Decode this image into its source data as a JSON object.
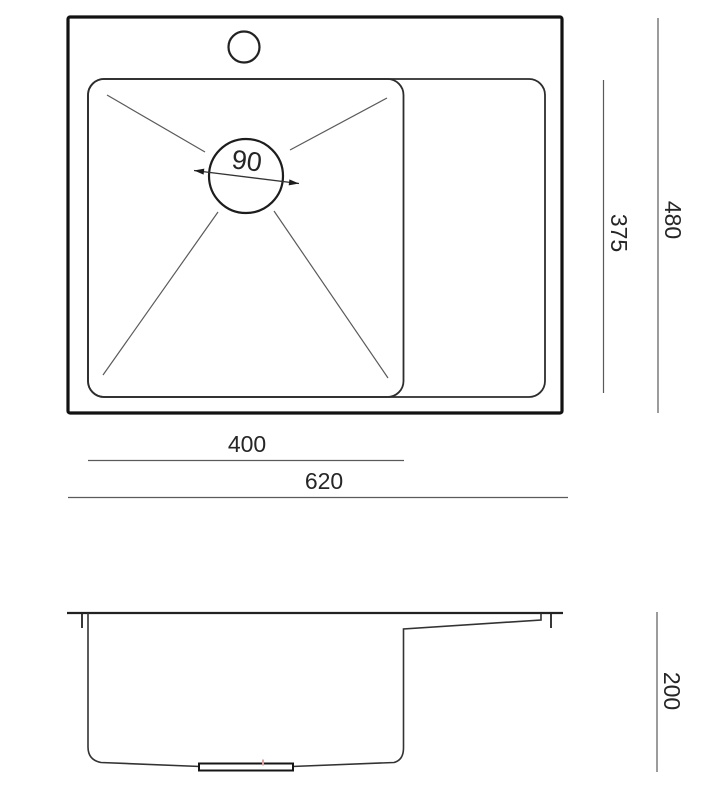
{
  "drawing": {
    "kind": "kitchen-sink-technical-drawing",
    "colors": {
      "background": "#ffffff",
      "thick_outline": "#121212",
      "medium_line": "#2d2d2d",
      "thin_line": "#5a5a5a",
      "label_text": "#262626",
      "drain_center_accent": "#e2a1a1"
    },
    "top_view": {
      "labels": {
        "drain_diameter": "90",
        "bowl_depth": "375",
        "overall_depth": "480",
        "bowl_width": "400",
        "overall_width": "620"
      }
    },
    "side_view": {
      "labels": {
        "bowl_height": "200"
      }
    }
  }
}
